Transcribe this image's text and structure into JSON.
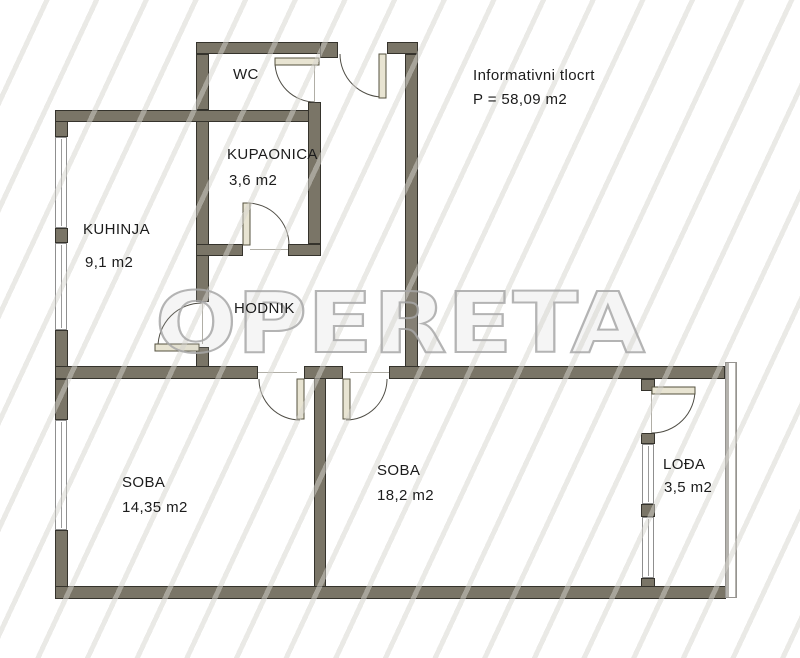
{
  "header": {
    "line1": "Informativni tlocrt",
    "line2": "P = 58,09 m2"
  },
  "watermark": {
    "text": "OPERETA"
  },
  "rooms": {
    "wc": {
      "name": "WC",
      "area": ""
    },
    "kupaonica": {
      "name": "KUPAONICA",
      "area": "3,6 m2"
    },
    "kuhinja": {
      "name": "KUHINJA",
      "area": "9,1 m2"
    },
    "hodnik": {
      "name": "HODNIK",
      "area": ""
    },
    "soba1": {
      "name": "SOBA",
      "area": "14,35 m2"
    },
    "soba2": {
      "name": "SOBA",
      "area": "18,2 m2"
    },
    "lodja": {
      "name": "LOĐA",
      "area": "3,5 m2"
    }
  },
  "colors": {
    "wall": "#7a7567",
    "wall_border": "#35332c",
    "door": "#e8e4d2",
    "door_border": "#55523f",
    "arc": "#4f4d45",
    "watermark": "#a8a8a8",
    "text": "#1c1c1c"
  }
}
